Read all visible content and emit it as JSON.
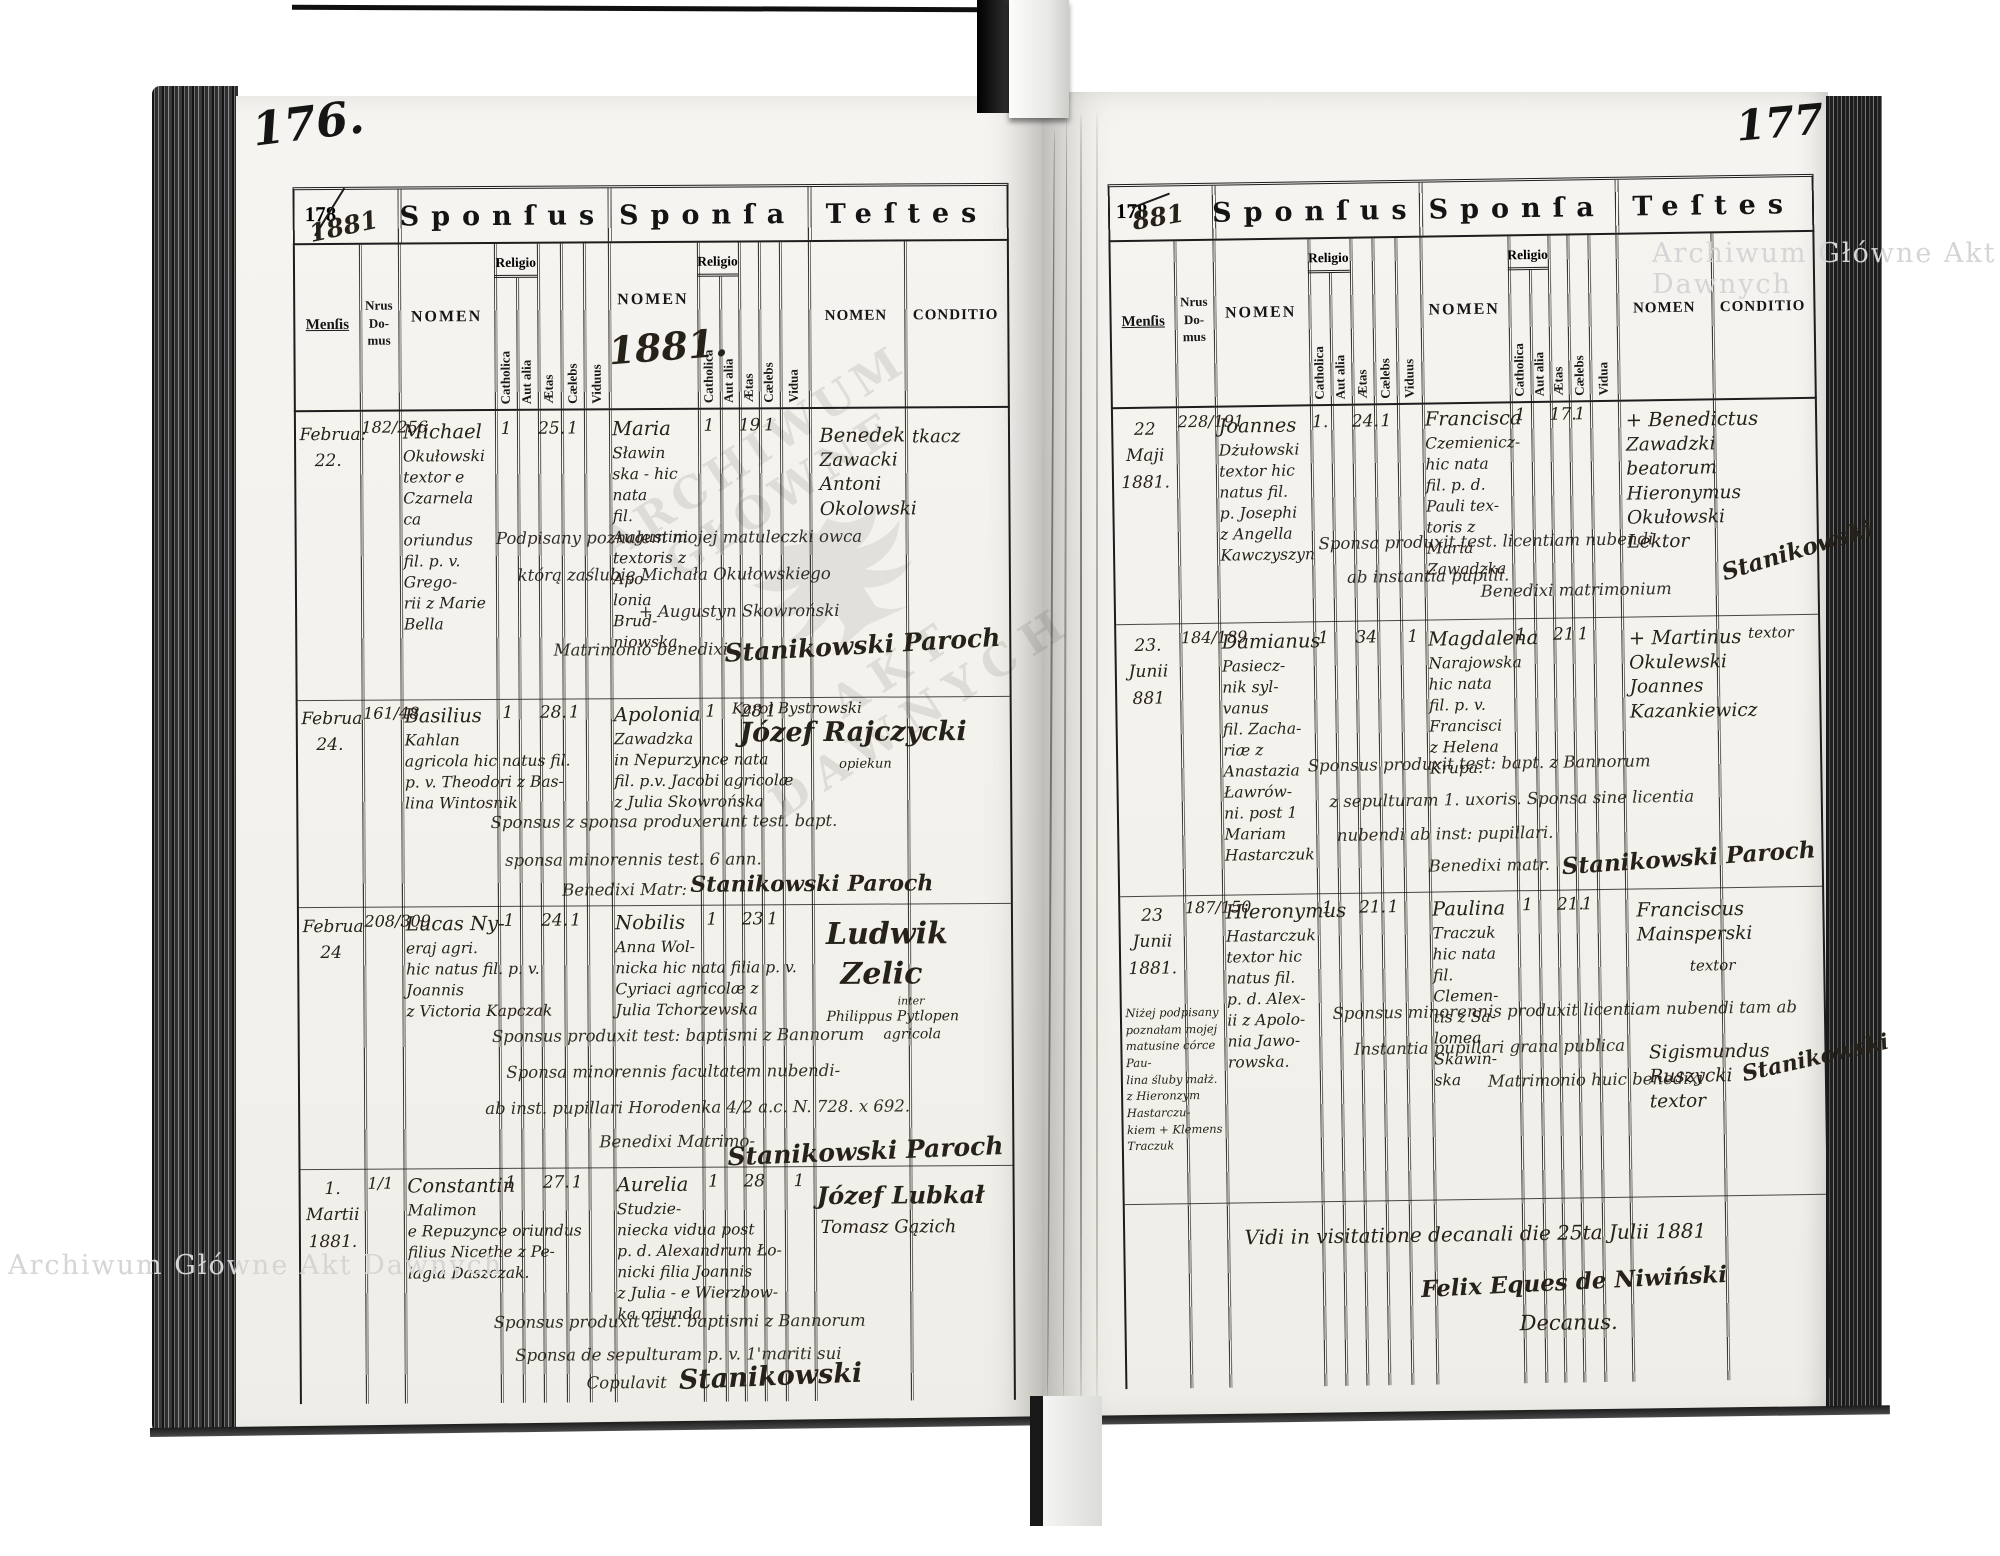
{
  "watermarks": {
    "top_right": "Archiwum Główne Akt Dawnych",
    "bottom_left": "Archiwum Główne Akt Dawnych",
    "stamp_top": "ARCHIWUM GŁÓWNE",
    "stamp_bottom": "AKT DAWNYCH"
  },
  "headers": {
    "form_no": "178",
    "sponsus": "Sponſus",
    "sponsa": "Sponſa",
    "testes": "Teſtes",
    "mensis": "Menſis",
    "nrus": "Nrus\nDo-\nmus",
    "nomen": "NOMEN",
    "religio": "Religio",
    "catholica": "Catholica",
    "aut_alia": "Aut alia",
    "aetas": "Ætas",
    "caelebs": "Cælebs",
    "viduus": "Viduus",
    "vidua": "Vidua",
    "conditio": "CONDITIO"
  },
  "left": {
    "page_no": "176.",
    "year_hw": "1881",
    "sponsa_year_hw": "1881.",
    "rows": [
      {
        "mensis": "Februa:\n22.",
        "nrus": "182/256",
        "sponsus": "Michael\nOkułowski\ntextor e Czarnela\nca oriundus\nfil. p. v. Grego-\nrii z Marie\nBella",
        "c1": "1",
        "ae1": "25.",
        "ce1": "1",
        "sponsa": "Maria\nSławin\nska - hic nata\nfil. Augustini\ntextoris z Apo-\nlonia Brud-\nniowska.",
        "c2": "1",
        "ae2": "19",
        "ce2": "1",
        "testes": "Benedek\nZawacki\nAntoni\nOkolowski",
        "conditio": "tkacz",
        "notes": [
          "Podpisany poznałem mojej matuleczki owca",
          "którą zaślubię Michała Okułowskiego",
          "+ Augustyn Skowroński",
          "Matrimonio benedixi"
        ],
        "sig": "Stanikowski Paroch"
      },
      {
        "mensis": "Februa\n24.",
        "nrus": "161/48",
        "sponsus": "Basilius\nKahlan\nagricola hic natus fil.\np. v. Theodori z Bas-\nlina Wintosnik",
        "c1": "1",
        "ae1": "28.",
        "ce1": "1",
        "sponsa": "Apolonia\nZawadzka\nin Nepurzynce nata\nfil. p.v. Jacobi agricolæ\nz Julia Skowrońska",
        "c2": "1",
        "ae2": "28",
        "ce2": "1",
        "testes_small": "Karol Bystrowski",
        "testes_big": "Józef Rajczycki",
        "testes_sub": "opiekun",
        "notes": [
          "Sponsus z sponsa produxerunt test. bapt.",
          "sponsa minorennis test. 6 ann.",
          "Benedixi Matr:"
        ],
        "sig": "Stanikowski Paroch"
      },
      {
        "mensis": "Februa\n24",
        "nrus": "208/309",
        "sponsus": "Lucas Ny-\neraj agri.\nhic natus fil. p. v. Joannis\nz Victoria Kapczak",
        "c1": "1",
        "ae1": "24.",
        "ce1": "1",
        "sponsa": "Nobilis\nAnna Wol-\nnicka hic nata filia p. v.\nCyriaci agricolæ z\nJulia Tchorzewska",
        "c2": "1",
        "ae2": "23",
        "ce2": "1",
        "testes_big1": "Ludwik",
        "testes_big2": "Zelic",
        "testes_s1": "inter",
        "testes_s2": "Philippus Pytlopen",
        "testes_s3": "agricola",
        "notes": [
          "Sponsus produxit test: baptismi z Bannorum",
          "Sponsa minorennis facultatem nubendi-",
          "ab inst. pupillari Horodenka 4/2 a.c. N. 728. x 692.",
          "Benedixi Matrimo-"
        ],
        "sig": "Stanikowski Paroch"
      },
      {
        "mensis": "1.\nMartii\n1881.",
        "nrus": "1/1",
        "sponsus": "Constantin\nMalimon\ne Repuzynce oriundus\nfilius Nicethe z Pe-\nlagia Daszczak.",
        "c1": "1",
        "ae1": "27.",
        "ce1": "1",
        "sponsa": "Aurelia\nStudzie-\nniecka vidua post\np. d. Alexandrum Ło-\nnicki filia Joannis\nz Julia - e Wierzbow-\nka oriunda",
        "c2": "1",
        "ae2": "28",
        "v2": "1",
        "testes_big": "Józef Lubkał",
        "testes_small": "Tomasz Gązich",
        "notes": [
          "Sponsus produxit test. baptismi z Bannorum",
          "Sponsa de sepulturam p. v. 1'mariti sui",
          "Copulavit"
        ],
        "sig": "Stanikowski"
      }
    ]
  },
  "right": {
    "page_no": "177",
    "year_hw": "881",
    "rows": [
      {
        "mensis": "22\nMaji\n1881.",
        "nrus": "228/191",
        "sponsus": "Joannes\nDżułowski\ntextor hic\nnatus fil.\np. Josephi\nz Angella\nKawczyszyn",
        "c1": "1.",
        "ae1": "24.",
        "ce1": "1",
        "sponsa": "Francisca\nCzemienicz-\nhic nata\nfil. p. d.\nPauli tex-\ntoris z\nMaria\nZawadzka",
        "c2": "1",
        "ae2": "17.",
        "ce2": "1",
        "testes": "+ Benedictus\nZawadzki\nbeatorum\nHieronymus\nOkułowski\nLektor",
        "notes": [
          "Sponsa produxit test. licentiam nubendi",
          "ab instantia pupilli.",
          "Benedixi matrimonium"
        ],
        "sig": "Stanikowski"
      },
      {
        "mensis": "23.\nJunii\n881",
        "nrus": "184/189",
        "sponsus": "Damianus\nPasiecz-\nnik syl-\nvanus\nfil. Zacha-\nriæ z\nAnastazia\nŁawrów-\nni. post 1\nMariam\nHastarczuk",
        "c1": "1",
        "ae1": "34",
        "v1": "1",
        "sponsa": "Magdalena\nNarajowska\nhic nata\nfil. p. v.\nFrancisci\nz Helena\nKrupa.",
        "c2": "1.",
        "ae2": "21",
        "ce2": "1",
        "testes": "+ Martinus\nOkulewski\nJoannes\nKazankiewicz",
        "conditio": "textor",
        "notes": [
          "Sponsus produxit test: bapt. z Bannorum",
          "z sepulturam 1. uxoris. Sponsa sine licentia",
          "nubendi ab inst: pupillari.",
          "Benedixi matr."
        ],
        "sig": "Stanikowski Paroch"
      },
      {
        "mensis": "23\nJunii\n1881.",
        "nrus": "187/150",
        "sponsus": "Hieronymus\nHastarczuk\ntextor hic\nnatus fil.\np. d. Alex-\nii z Apolo-\nnia Jawo-\nrowska.",
        "c1": "1",
        "ae1": "21.",
        "ce1": "1",
        "sponsa": "Paulina\nTraczuk\nhic nata\nfil. Clemen-\ntis z Sa-\nlomea\nSkawin-\nska",
        "c2": "1",
        "ae2": "21.",
        "ce2": "1",
        "testes1": "Franciscus\nMainsperski",
        "conditio1": "textor",
        "testes2": "Sigismundus\nRuszycki\ntextor",
        "margin_note": "Niżej podpisany\npoznałam mojej\nmatusine córce Pau-\nlina śluby małż.\nz Hieronzym Hastarczu-\nkiem + Klemens Traczuk",
        "notes": [
          "Sponsus minorennis produxit licentiam nubendi tam ab",
          "Instantia pupillari grana publica",
          "Matrimonio huic benedixi"
        ],
        "sig": "Stanikowski"
      }
    ],
    "vidi_line1": "Vidi in visitatione decanali die 25ta Julii 1881",
    "vidi_line2": "Felix Eques de Niwiński",
    "vidi_line3": "Decanus."
  }
}
